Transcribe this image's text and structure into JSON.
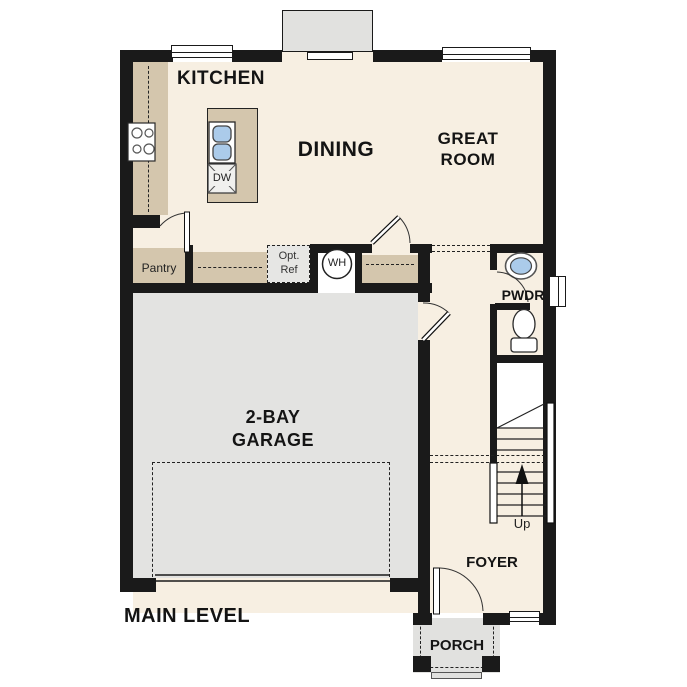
{
  "title": "MAIN LEVEL",
  "rooms": {
    "kitchen": "KITCHEN",
    "dining": "DINING",
    "great_room": "GREAT ROOM",
    "garage": "2-BAY GARAGE",
    "pwdr": "PWDR",
    "foyer": "FOYER",
    "porch": "PORCH",
    "pantry": "Pantry"
  },
  "annotations": {
    "up": "Up",
    "water_heater": "WH",
    "dishwasher": "DW",
    "optional_refrigerator": "Opt. Ref"
  },
  "colors": {
    "wall": "#1a1a1a",
    "floor": "#f7efe2",
    "counter": "#d4c6ad",
    "garage": "#e3e3e1",
    "porch": "#e1e1df",
    "appliance": "#e6e6e4",
    "sink": "#abcbea"
  }
}
